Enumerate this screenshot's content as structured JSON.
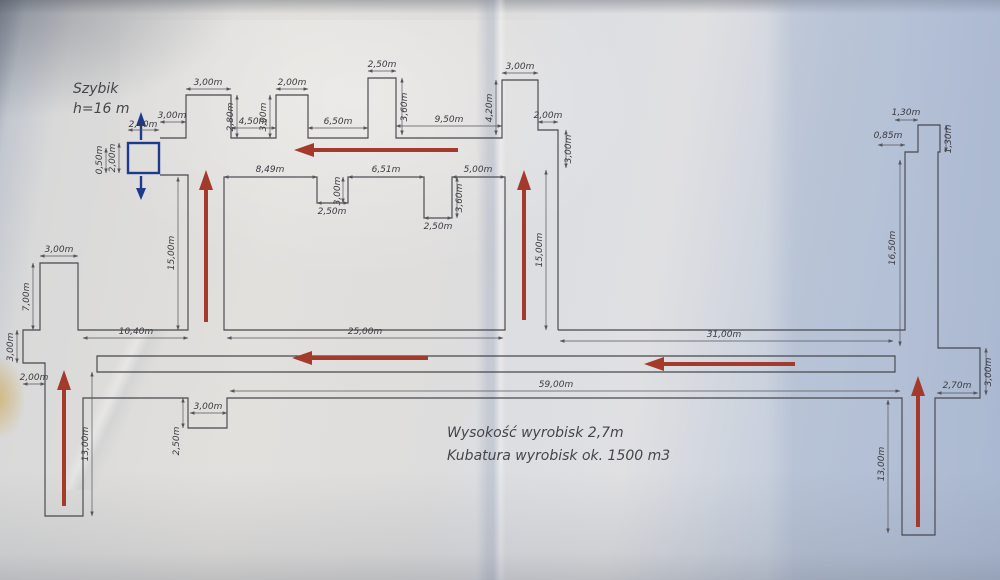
{
  "title_block": {
    "szybik_label": "Szybik",
    "szybik_height": "h=16 m"
  },
  "notes": {
    "line1": "Wysokość wyrobisk  2,7m",
    "line2": "Kubatura wyrobisk ok.  1500 m3"
  },
  "dims": {
    "szybik": [
      "2,40m",
      "2,00m",
      "0,50m"
    ],
    "top_wall": [
      "3,00m",
      "3,00m",
      "2,80m",
      "4,50m",
      "3,00m",
      "2,00m",
      "6,50m",
      "2,50m",
      "3,60m",
      "9,50m",
      "4,20m",
      "3,00m",
      "2,00m",
      "3,00m"
    ],
    "island1": [
      "8,49m",
      "2,50m",
      "3,00m",
      "6,51m",
      "2,50m",
      "3,60m",
      "5,00m"
    ],
    "verticals": [
      "15,00m",
      "15,00m",
      "16,50m",
      "13,00m",
      "13,00m"
    ],
    "mid": [
      "25,00m",
      "31,00m",
      "59,00m",
      "10,40m"
    ],
    "left_spur": [
      "3,00m",
      "7,00m",
      "3,00m",
      "2,00m",
      "3,00m",
      "2,50m"
    ],
    "right": [
      "1,30m",
      "1,30m",
      "0,85m",
      "2,70m",
      "3,00m"
    ]
  },
  "colors": {
    "flow_arrow_red": "#a43a2b",
    "shaft_blue": "#1e3a8f",
    "wall_line": "#47474e",
    "dim_text": "#3a3a40",
    "paper": "#e2e0dd",
    "paper_blue_band": "#b7c3d7"
  }
}
